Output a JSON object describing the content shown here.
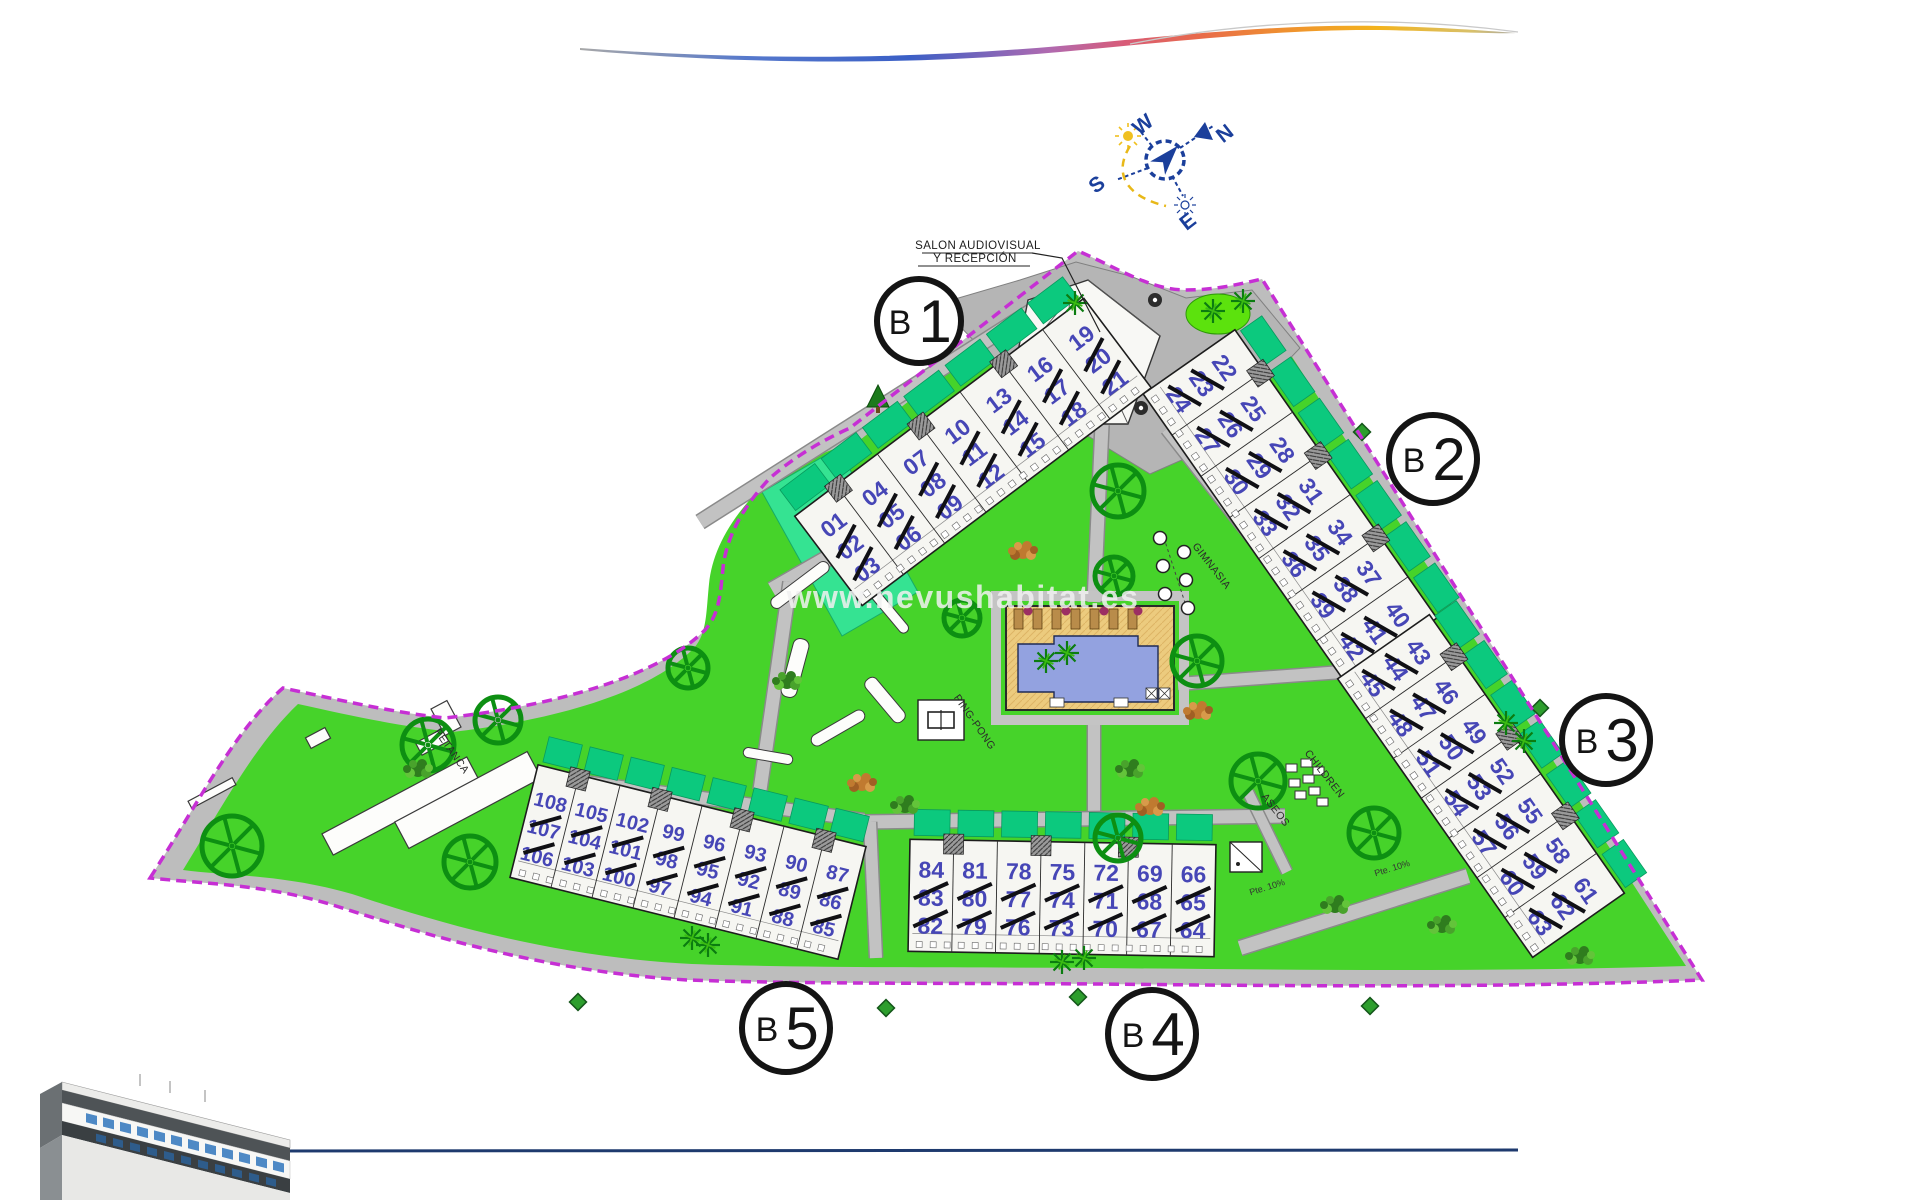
{
  "watermark": "www.nevushabitat.es",
  "compass": {
    "n": "N",
    "e": "E",
    "s": "S",
    "w": "W"
  },
  "labels": {
    "reception_line1": "SALON AUDIOVISUAL",
    "reception_line2": "Y RECEPCIÓN",
    "petanca": "PETANCA",
    "ping_pong": "PING-PONG",
    "gimnasia": "GIMNASIA",
    "children": "CHILDREN",
    "aseos": "ASEOS",
    "ramp_grade_1": "Pte. 10%",
    "ramp_grade_2": "Pte. 10%"
  },
  "colors": {
    "lawn": "#46d32a",
    "lawn_bright": "#5ce20d",
    "garden": "#0cc97e",
    "mint": "#35e392",
    "road": "#c2c2c2",
    "road_edge": "#8a8a8a",
    "plaza": "#b5b5b5",
    "boundary": "#c62fd4",
    "building_fill": "#f6f6f2",
    "unit_number": "#4646b6",
    "pool_water": "#93a2e0",
    "pool_deck": "#eccb7e",
    "tree": "#0d8f12",
    "compass_blue": "#1b3f9b",
    "sun_yellow": "#f0c020",
    "bottom_line": "#1e3a6e"
  },
  "blocks": [
    {
      "id": "b1",
      "label": "B1",
      "columns": [
        [
          "01",
          "02",
          "03"
        ],
        [
          "04",
          "05",
          "06"
        ],
        [
          "07",
          "08",
          "09"
        ],
        [
          "10",
          "11",
          "12"
        ],
        [
          "13",
          "14",
          "15"
        ],
        [
          "16",
          "17",
          "18"
        ],
        [
          "19",
          "20",
          "21"
        ]
      ]
    },
    {
      "id": "b2",
      "label": "B2",
      "columns": [
        [
          "22",
          "23",
          "24"
        ],
        [
          "25",
          "26",
          "27"
        ],
        [
          "28",
          "29",
          "30"
        ],
        [
          "31",
          "32",
          "33"
        ],
        [
          "34",
          "35",
          "36"
        ],
        [
          "37",
          "38",
          "39"
        ],
        [
          "40",
          "41",
          "42"
        ]
      ]
    },
    {
      "id": "b3",
      "label": "B3",
      "columns": [
        [
          "43",
          "44",
          "45"
        ],
        [
          "46",
          "47",
          "48"
        ],
        [
          "49",
          "50",
          "51"
        ],
        [
          "52",
          "53",
          "54"
        ],
        [
          "55",
          "56",
          "57"
        ],
        [
          "58",
          "59",
          "60"
        ],
        [
          "61",
          "62",
          "63"
        ]
      ]
    },
    {
      "id": "b4",
      "label": "B4",
      "columns": [
        [
          "84",
          "83",
          "82"
        ],
        [
          "81",
          "80",
          "79"
        ],
        [
          "78",
          "77",
          "76"
        ],
        [
          "75",
          "74",
          "73"
        ],
        [
          "72",
          "71",
          "70"
        ],
        [
          "69",
          "68",
          "67"
        ],
        [
          "66",
          "65",
          "64"
        ]
      ]
    },
    {
      "id": "b5",
      "label": "B5",
      "columns": [
        [
          "108",
          "107",
          "106"
        ],
        [
          "105",
          "104",
          "103"
        ],
        [
          "102",
          "101",
          "100"
        ],
        [
          "99",
          "98",
          "97"
        ],
        [
          "96",
          "95",
          "94"
        ],
        [
          "93",
          "92",
          "91"
        ],
        [
          "90",
          "89",
          "88"
        ],
        [
          "87",
          "86",
          "85"
        ]
      ]
    }
  ]
}
